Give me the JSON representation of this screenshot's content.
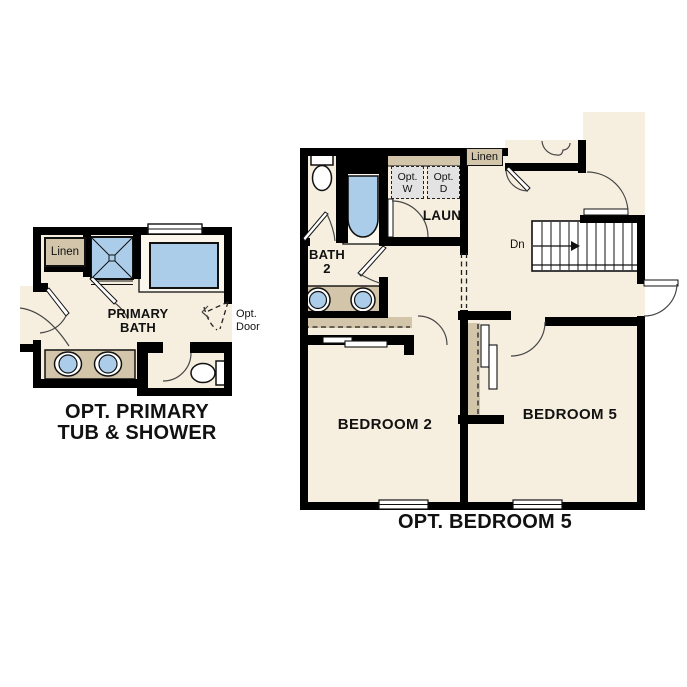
{
  "colors": {
    "floor": "#f6efdf",
    "accent_tan": "#d3c5aa",
    "fixture_blue": "#abcdea",
    "appliance_gray": "#e3e3e3",
    "wall": "#000000"
  },
  "left_plan": {
    "caption": {
      "line1": "OPT. PRIMARY",
      "line2": "TUB & SHOWER"
    },
    "room_label": {
      "line1": "PRIMARY",
      "line2": "BATH"
    },
    "linen_label": "Linen",
    "opt_door_label": {
      "line1": "Opt.",
      "line2": "Door"
    }
  },
  "right_plan": {
    "caption": "OPT. BEDROOM 5",
    "bath_label": {
      "line1": "BATH",
      "line2": "2"
    },
    "laundry_label": "LAUN",
    "washer_label": {
      "line1": "Opt.",
      "line2": "W"
    },
    "dryer_label": {
      "line1": "Opt.",
      "line2": "D"
    },
    "linen_label": "Linen",
    "stairs_label": "Dn",
    "bedroom2_label": "BEDROOM 2",
    "bedroom5_label": "BEDROOM 5"
  }
}
